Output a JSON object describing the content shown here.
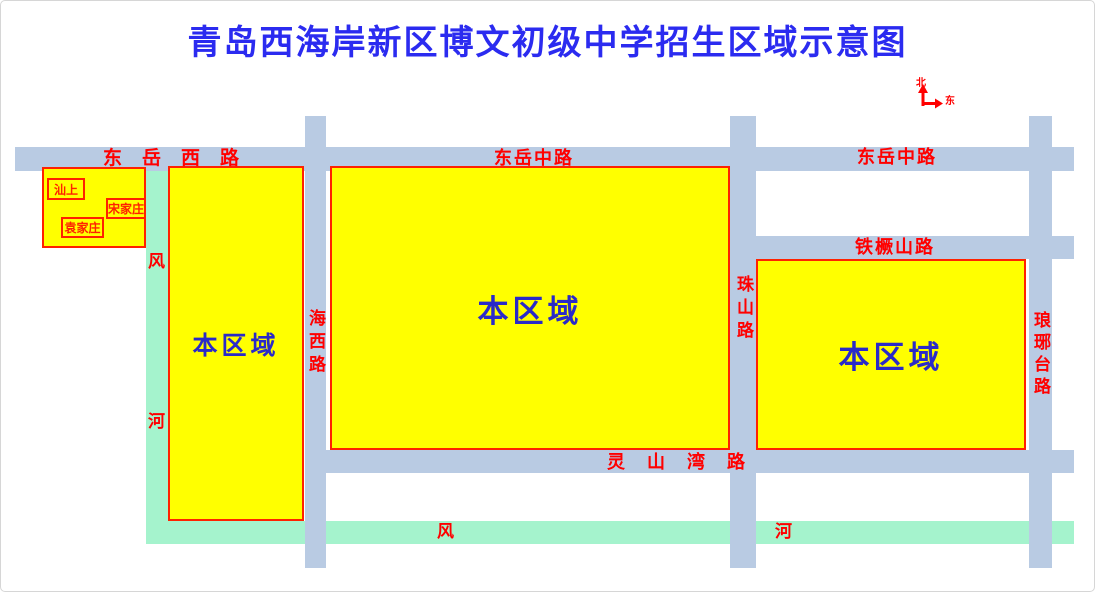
{
  "title": "青岛西海岸新区博文初级中学招生区域示意图",
  "compass": {
    "north": "北",
    "east": "东"
  },
  "roads": {
    "dongyue_xi": "东岳西路",
    "dongyue_zhong_mid": "东岳中路",
    "dongyue_zhong_right": "东岳中路",
    "tiejueshan": "铁橛山路",
    "lingshanwan": "灵山湾路",
    "haixi": "海西路",
    "zhushan": "珠山路",
    "langyatai": "琅琊台路"
  },
  "river": {
    "feng": "风",
    "he": "河"
  },
  "regions": {
    "left": "本区域",
    "middle": "本区域",
    "right": "本区域"
  },
  "villages": {
    "shanshang": "汕上",
    "songjiazhuang": "宋家庄",
    "yuanjiazhuang": "袁家庄"
  },
  "colors": {
    "road": "#b9cbe3",
    "river": "#a5f3cd",
    "zone_fill": "#ffff00",
    "zone_border": "#ff2200",
    "road_label": "#ff0000",
    "zone_label": "#2a2ac8",
    "title": "#2b2bf0"
  }
}
